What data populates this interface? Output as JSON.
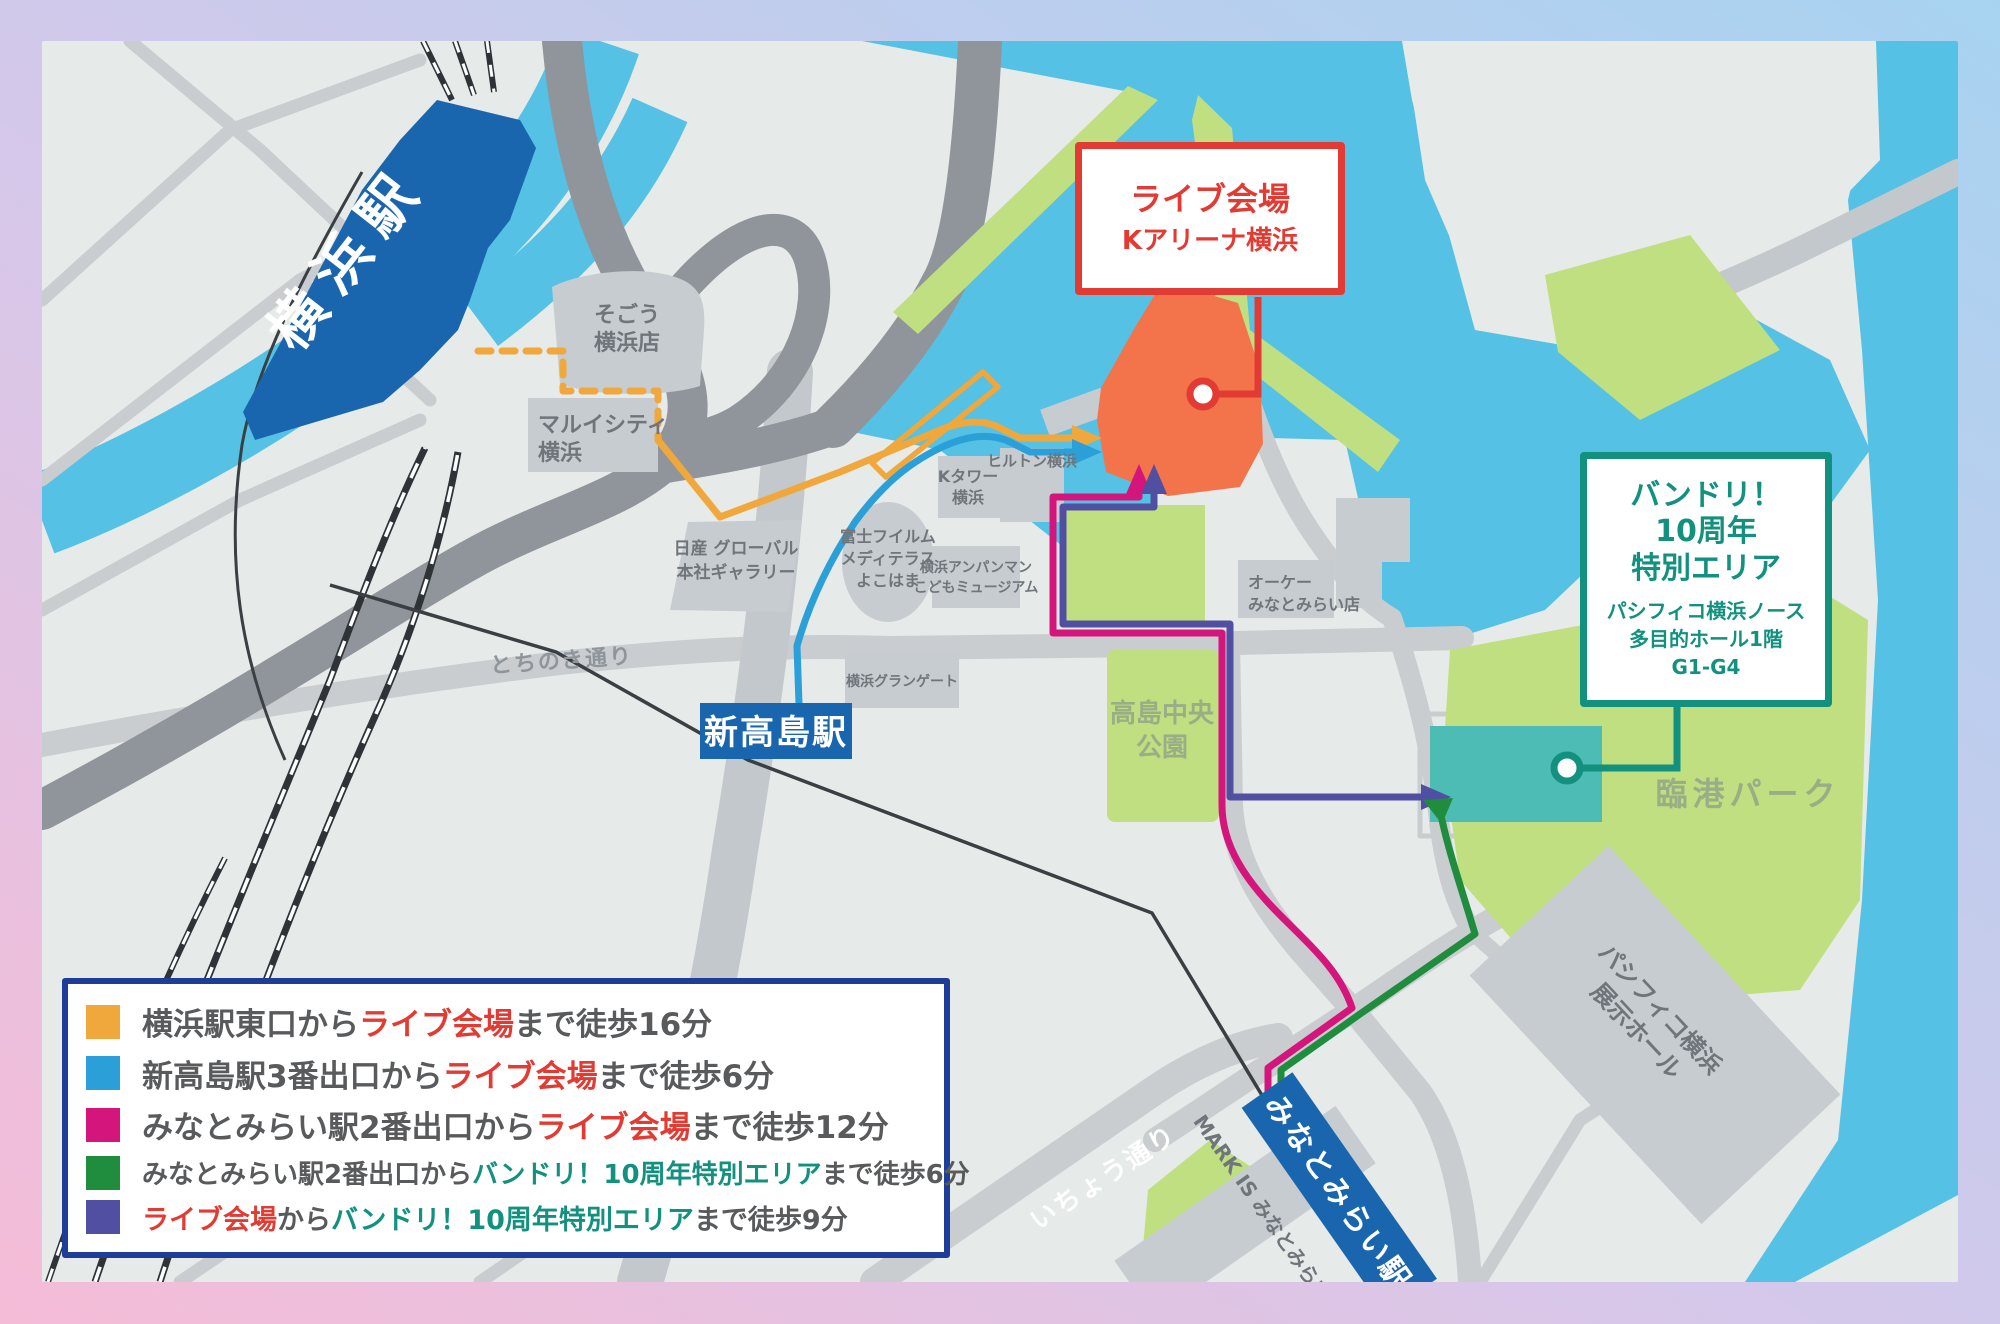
{
  "colors": {
    "frame_pink": "#f5bcd7",
    "frame_blue": "#a7d3f1",
    "map_bg": "#e6eae8",
    "water": "#55c1e4",
    "park": "#bfdf80",
    "road": "#c9cdd0",
    "road_dark": "#8f959a",
    "building": "#c7ccd1",
    "station_blue": "#1966ae",
    "venue_orange": "#f3734b",
    "special_teal": "#4cbcb4",
    "callout_red": "#e23b33",
    "callout_teal": "#12917e",
    "legend_border": "#1e3d99",
    "legend_text": "#595a5c"
  },
  "routes": {
    "yokohama_east": {
      "color": "#f0a73c",
      "label": "横浜駅東口ルート"
    },
    "shintakashima": {
      "color": "#2b9fd8",
      "label": "新高島駅ルート"
    },
    "minatomirai_live": {
      "color": "#d4157b",
      "label": "みなとみらい駅→ライブ会場ルート"
    },
    "minatomirai_special": {
      "color": "#1f8c3e",
      "label": "みなとみらい駅→特別エリアルート"
    },
    "live_special": {
      "color": "#514fa2",
      "label": "ライブ会場→特別エリアルート"
    }
  },
  "callouts": {
    "live": {
      "title": "ライブ会場",
      "subtitle": "Kアリーナ横浜"
    },
    "special": {
      "title_lines": [
        "バンドリ！",
        "10周年",
        "特別エリア"
      ],
      "sub_lines": [
        "パシフィコ横浜ノース",
        "多目的ホール1階",
        "G1-G4"
      ]
    }
  },
  "stations": {
    "yokohama": "横浜駅",
    "shintakashima": "新高島駅",
    "minatomirai": "みなとみらい駅"
  },
  "map_labels": {
    "sogo": [
      "そごう",
      "横浜店"
    ],
    "marui": [
      "マルイシティ",
      "横浜"
    ],
    "nissan": [
      "日産 グローバル",
      "本社ギャラリー"
    ],
    "fujifilm": [
      "富士フイルム",
      "メディテラス",
      "よこはま"
    ],
    "ktower": [
      "Kタワー",
      "横浜"
    ],
    "hilton": "ヒルトン横浜",
    "anpanman": [
      "横浜アンパンマン",
      "こどもミュージアム"
    ],
    "grangate": "横浜グランゲート",
    "okstore": [
      "オーケー",
      "みなとみらい店"
    ],
    "takashima_park": [
      "高島中央",
      "公園"
    ],
    "rinko_park": "臨港パーク",
    "pacifico_hall": [
      "パシフィコ横浜",
      "展示ホール"
    ],
    "markis": "MARK IS みなとみらい",
    "tochinoki": "とちのき通り",
    "icho": "いちょう通り"
  },
  "legend": {
    "items": [
      {
        "color": "#f0a73c",
        "parts": [
          {
            "text": "横浜駅東口から",
            "color": "#595a5c"
          },
          {
            "text": "ライブ会場",
            "color": "#e23b33"
          },
          {
            "text": "まで徒歩16分",
            "color": "#595a5c"
          }
        ]
      },
      {
        "color": "#2b9fd8",
        "parts": [
          {
            "text": "新高島駅3番出口から",
            "color": "#595a5c"
          },
          {
            "text": "ライブ会場",
            "color": "#e23b33"
          },
          {
            "text": "まで徒歩6分",
            "color": "#595a5c"
          }
        ]
      },
      {
        "color": "#d4157b",
        "parts": [
          {
            "text": "みなとみらい駅2番出口から",
            "color": "#595a5c"
          },
          {
            "text": "ライブ会場",
            "color": "#e23b33"
          },
          {
            "text": "まで徒歩12分",
            "color": "#595a5c"
          }
        ]
      },
      {
        "color": "#1f8c3e",
        "parts": [
          {
            "text": "みなとみらい駅2番出口から",
            "color": "#595a5c"
          },
          {
            "text": "バンドリ！10周年特別エリア",
            "color": "#12917e"
          },
          {
            "text": "まで徒歩6分",
            "color": "#595a5c"
          }
        ]
      },
      {
        "color": "#514fa2",
        "parts": [
          {
            "text": "ライブ会場",
            "color": "#e23b33"
          },
          {
            "text": "から",
            "color": "#595a5c"
          },
          {
            "text": "バンドリ！10周年特別エリア",
            "color": "#12917e"
          },
          {
            "text": "まで徒歩9分",
            "color": "#595a5c"
          }
        ]
      }
    ]
  }
}
